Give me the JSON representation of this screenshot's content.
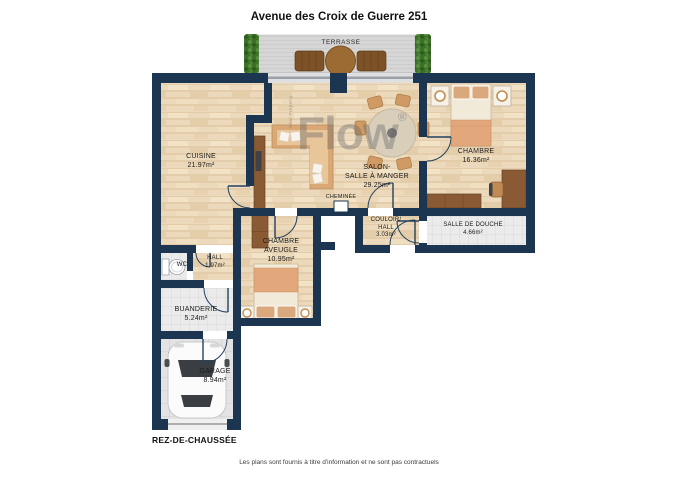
{
  "header": {
    "title": "Avenue des Croix de Guerre 251"
  },
  "floor_label": "REZ-DE-CHAUSSÉE",
  "footer": {
    "disclaimer": "Les plans sont fournis à titre d'information et ne sont pas contractuels"
  },
  "watermark": {
    "brand": "Flow",
    "registered": "®",
    "vertical_text": "Real Property"
  },
  "rooms": {
    "terrasse": {
      "name": "TERRASSE"
    },
    "cuisine": {
      "name": "CUISINE",
      "area": "21.97m²"
    },
    "salon": {
      "name_line1": "SALON-",
      "name_line2": "SALLE À MANGER",
      "area": "29.25m²"
    },
    "cheminee": {
      "name": "CHEMINÉE"
    },
    "chambre": {
      "name": "CHAMBRE",
      "area": "16.36m²"
    },
    "couloir": {
      "name_line1": "COULOIR/",
      "name_line2": "HALL",
      "area": "3.03m²"
    },
    "salle_de_douche": {
      "name": "SALLE DE DOUCHE",
      "area": "4.66m²"
    },
    "chambre_aveugle": {
      "name_line1": "CHAMBRE",
      "name_line2": "AVEUGLE",
      "area": "10.95m²"
    },
    "hall": {
      "name": "HALL",
      "area": "1.97m²"
    },
    "wc": {
      "name": "WC"
    },
    "buanderie": {
      "name": "BUANDERIE",
      "area": "5.24m²"
    },
    "garage": {
      "name": "GARAGE",
      "area": "8.94m²"
    }
  },
  "colors": {
    "wall": "#1c3551",
    "wood_floor": "#ecd9bb",
    "tile_floor": "#ebebeb",
    "garage_floor": "#e3e3e3",
    "terrace_deck": "#d6d6d6",
    "hedge_green": "#477d31",
    "furniture_brown": "#8a5a35",
    "upholstery_tan": "#d9a876",
    "bed_blanket": "#e2a87c",
    "watermark_gray": "#6e6e6e"
  }
}
